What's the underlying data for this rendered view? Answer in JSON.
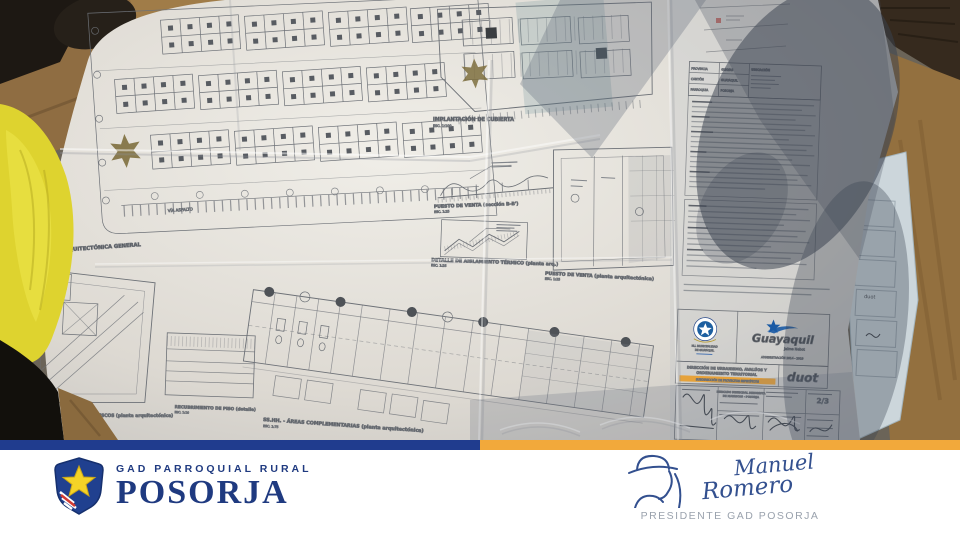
{
  "colors": {
    "navy_bar": "#203c8e",
    "gold_bar": "#f2a93b",
    "brand_navy": "#1f3a80",
    "guayaquil_blue": "#1a5aa5",
    "duot_red": "#cf4433",
    "sheet_red": "#c23a2f",
    "highlight_orange": "#e89c2a"
  },
  "plan": {
    "labels": {
      "planta_general": {
        "title": "PLANTA ARQUITECTÓNICA GENERAL",
        "scale": "ESC. 1:100"
      },
      "implantacion": {
        "title": "IMPLANTACIÓN DE CUBIERTA",
        "scale": "ESC. 1:100"
      },
      "puesto_seccion": {
        "title": "PUESTO DE VENTA (sección B-B')",
        "scale": "ESC. 1:25"
      },
      "detalle_termico": {
        "title": "DETALLE DE AISLAMIENTO TÉRMICO (planta arq.)",
        "scale": "ESC. 1:25"
      },
      "puesto_planta": {
        "title": "PUESTO DE VENTA (planta arquitectónica)",
        "scale": "ESC. 1:25"
      },
      "areas_complementarias": {
        "title": "SS.HH. - ÁREAS COMPLEMENTARIAS (planta arquitectónica)",
        "scale": "ESC. 1:75"
      },
      "recubrimiento": {
        "title": "RECUBRIMIENTO DE PISO (detalle)",
        "scale": "ESC. 1:10"
      },
      "centro_acopio": {
        "title": "CENTRO DE ACOPIO DE MARISCOS (planta arquitectónica)",
        "scale": "ESC. 1:50"
      },
      "via_asfalto": "VÍA ASFALTO"
    },
    "title_block": {
      "location_header": "UBICACIÓN",
      "location_rows": [
        "PROVINCIA",
        "CANTÓN",
        "PARROQUIA"
      ],
      "location_values": [
        "GUAYAS",
        "GUAYAQUIL",
        "POSORJA"
      ],
      "seal_caption": [
        "M.I. MUNICIPALIDAD",
        "DE GUAYAQUIL"
      ],
      "city_logo": "Guayaquil",
      "city_logo_sub": "Jaime Nebot",
      "city_logo_admin": "ADMINISTRACIÓN 2014 - 2019",
      "direction_line1": "DIRECCIÓN DE URBANISMO, AVALÚOS Y",
      "direction_line2": "ORDENAMIENTO TERRITORIAL",
      "subdirection": "SUBDIRECCIÓN DE PROYECTOS ESPECÍFICOS",
      "duot": "duot",
      "project_line1": "MERCADO MUNICIPAL MINORISTA",
      "project_line2": "DE MARISCOS - POSORJA",
      "sheet": "2/3"
    }
  },
  "footer": {
    "brand_top": "GAD PARROQUIAL RURAL",
    "brand_name": "POSORJA",
    "signature_first": "Manuel",
    "signature_last": "Romero",
    "signature_title": "PRESIDENTE GAD POSORJA"
  }
}
